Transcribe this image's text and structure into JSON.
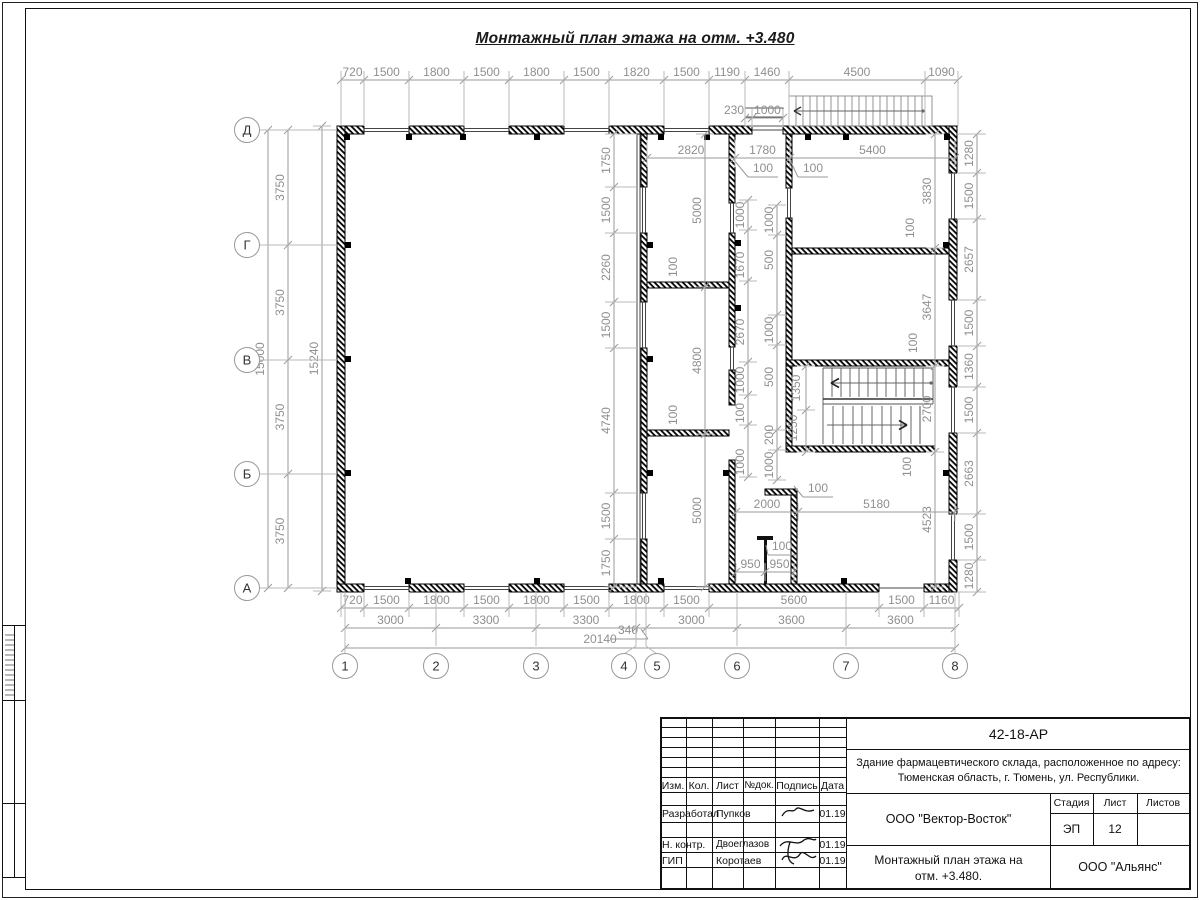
{
  "sheet": {
    "drawing_title": "Монтажный план этажа на отм. +3.480",
    "doc_number": "42-18-АР",
    "project_name_line1": "Здание фармацевтического склада, расположенное по адресу:",
    "project_name_line2": "Тюменская область, г. Тюмень, ул. Республики.",
    "contractor": "ООО \"Вектор-Восток\"",
    "client": "ООО \"Альянс\"",
    "tb_title_line1": "Монтажный план этажа на",
    "tb_title_line2": "отм. +3.480.",
    "stage_label": "Стадия",
    "stage_value": "ЭП",
    "sheet_label": "Лист",
    "sheet_value": "12",
    "sheets_label": "Листов",
    "sheets_value": "",
    "header_cols": [
      "Изм.",
      "Кол.",
      "Лист",
      "№док.",
      "Подпись",
      "Дата"
    ],
    "sign_rows": [
      {
        "role": "Разработал",
        "name": "Пупков",
        "date": "01.19"
      },
      {
        "role": "Н. контр.",
        "name": "Двоеглазов",
        "date": "01.19"
      },
      {
        "role": "ГИП",
        "name": "Коротаев",
        "date": "01.19"
      }
    ]
  },
  "plan": {
    "row_axes": [
      {
        "l": "Д",
        "y": 130
      },
      {
        "l": "Г",
        "y": 245
      },
      {
        "l": "В",
        "y": 360
      },
      {
        "l": "Б",
        "y": 474
      },
      {
        "l": "А",
        "y": 588
      }
    ],
    "col_axes": [
      {
        "l": "1",
        "x": 345,
        "cx": 345
      },
      {
        "l": "2",
        "x": 436,
        "cx": 436
      },
      {
        "l": "3",
        "x": 536,
        "cx": 536
      },
      {
        "l": "4",
        "x": 636,
        "cx": 624
      },
      {
        "l": "5",
        "x": 646,
        "cx": 657
      },
      {
        "l": "6",
        "x": 737,
        "cx": 737
      },
      {
        "l": "7",
        "x": 846,
        "cx": 846
      },
      {
        "l": "8",
        "x": 955,
        "cx": 955
      }
    ],
    "chains": [
      {
        "dir": "h",
        "pos": 80,
        "reach": 126,
        "ticks": [
          341,
          364,
          409,
          464,
          509,
          564,
          609,
          664,
          709,
          745,
          789,
          925,
          958
        ],
        "labels": [
          "720",
          "1500",
          "1800",
          "1500",
          "1800",
          "1500",
          "1820",
          "1500",
          "1190",
          "1460",
          "4500",
          "1090"
        ]
      },
      {
        "dir": "h",
        "pos": 118,
        "reach": 126,
        "ticks": [
          745,
          752,
          783
        ],
        "labels": [
          null,
          "1000"
        ]
      },
      {
        "dir": "h",
        "pos": 158,
        "reach": 140,
        "ticks": [
          647,
          735,
          790,
          955
        ],
        "labels": [
          "2820",
          "1780",
          "5400"
        ]
      },
      {
        "dir": "h",
        "pos": 512,
        "ticks": [
          736,
          798,
          955
        ],
        "labels": [
          "2000",
          "5180"
        ]
      },
      {
        "dir": "h",
        "pos": 572,
        "ticks": [
          736,
          765,
          794
        ],
        "labels": [
          "950",
          "950"
        ]
      },
      {
        "dir": "h",
        "pos": 608,
        "reach": 592,
        "ticks": [
          341,
          364,
          409,
          464,
          509,
          564,
          609,
          664,
          709,
          879,
          924,
          959
        ],
        "labels": [
          "720",
          "1500",
          "1800",
          "1500",
          "1800",
          "1500",
          "1800",
          "1500",
          "5600",
          "1500",
          "1160"
        ]
      },
      {
        "dir": "h",
        "pos": 628,
        "ticks": [
          345,
          436,
          536,
          636,
          646,
          737,
          846,
          955
        ],
        "labels": [
          "3000",
          "3300",
          "3300",
          null,
          "3000",
          "3600",
          "3600"
        ]
      },
      {
        "dir": "h",
        "pos": 648,
        "ticks": [
          345,
          955
        ],
        "labels": [
          null
        ]
      },
      {
        "dir": "v",
        "pos": 268,
        "ticks": [
          130,
          588
        ],
        "labels": [
          "15000"
        ]
      },
      {
        "dir": "v",
        "pos": 288,
        "ticks": [
          130,
          245,
          360,
          474,
          588
        ],
        "labels": [
          "3750",
          "3750",
          "3750",
          "3750"
        ]
      },
      {
        "dir": "v",
        "pos": 322,
        "ticks": [
          126,
          591
        ],
        "labels": [
          "15240"
        ]
      },
      {
        "dir": "v",
        "pos": 614,
        "reach": 637,
        "ticks": [
          134,
          187,
          233,
          302,
          348,
          493,
          539,
          587
        ],
        "labels": [
          "1750",
          "1500",
          "2260",
          "1500",
          "4740",
          "1500",
          "1750"
        ]
      },
      {
        "dir": "v",
        "pos": 705,
        "ticks": [
          134,
          287,
          434,
          587
        ],
        "labels": [
          "5000",
          "4800",
          "5000"
        ]
      },
      {
        "dir": "v",
        "pos": 748,
        "ticks": [
          200,
          230,
          281,
          362,
          395,
          425,
          477
        ],
        "labels": []
      },
      {
        "dir": "v",
        "pos": 777,
        "ticks": [
          205,
          235,
          315,
          345,
          430,
          450,
          480
        ],
        "labels": []
      },
      {
        "dir": "v",
        "pos": 806,
        "ticks": [
          366,
          410,
          452
        ],
        "labels": []
      },
      {
        "dir": "v",
        "pos": 935,
        "ticks": [
          134,
          248,
          366,
          452,
          587
        ],
        "labels": [
          "3830",
          "3647",
          "2700",
          "4523"
        ]
      },
      {
        "dir": "v",
        "pos": 977,
        "reach": 957,
        "ticks": [
          134,
          173,
          219,
          300,
          346,
          387,
          433,
          514,
          560,
          592
        ],
        "labels": [
          "1280",
          "1500",
          "2657",
          "1500",
          "1360",
          "1500",
          "2663",
          "1500",
          "1280"
        ]
      }
    ],
    "labels": [
      {
        "t": "340",
        "x": 628,
        "y": 634,
        "r": 0
      },
      {
        "t": "20140",
        "x": 600,
        "y": 643,
        "r": 0
      },
      {
        "t": "230",
        "x": 734,
        "y": 114,
        "r": 0
      },
      {
        "t": "1000",
        "x": 744,
        "y": 215,
        "r": 1
      },
      {
        "t": "1670",
        "x": 744,
        "y": 265,
        "r": 1
      },
      {
        "t": "2670",
        "x": 744,
        "y": 332,
        "r": 1
      },
      {
        "t": "1000",
        "x": 744,
        "y": 380,
        "r": 1
      },
      {
        "t": "100",
        "x": 744,
        "y": 413,
        "r": 1
      },
      {
        "t": "1000",
        "x": 744,
        "y": 462,
        "r": 1
      },
      {
        "t": "1000",
        "x": 773,
        "y": 220,
        "r": 1
      },
      {
        "t": "500",
        "x": 773,
        "y": 260,
        "r": 1
      },
      {
        "t": "1000",
        "x": 773,
        "y": 330,
        "r": 1
      },
      {
        "t": "500",
        "x": 773,
        "y": 377,
        "r": 1
      },
      {
        "t": "200",
        "x": 773,
        "y": 435,
        "r": 1
      },
      {
        "t": "1000",
        "x": 773,
        "y": 465,
        "r": 1
      },
      {
        "t": "100",
        "x": 763,
        "y": 172,
        "r": 0
      },
      {
        "t": "100",
        "x": 813,
        "y": 172,
        "r": 0
      },
      {
        "t": "100",
        "x": 914,
        "y": 228,
        "r": 1
      },
      {
        "t": "100",
        "x": 917,
        "y": 343,
        "r": 1
      },
      {
        "t": "100",
        "x": 677,
        "y": 267,
        "r": 1
      },
      {
        "t": "100",
        "x": 677,
        "y": 415,
        "r": 1
      },
      {
        "t": "100",
        "x": 911,
        "y": 467,
        "r": 1
      },
      {
        "t": "100",
        "x": 818,
        "y": 492,
        "r": 0
      },
      {
        "t": "100",
        "x": 782,
        "y": 550,
        "r": 0
      },
      {
        "t": "1350",
        "x": 800,
        "y": 388,
        "r": 1
      },
      {
        "t": "1250",
        "x": 797,
        "y": 428,
        "r": 1
      }
    ]
  }
}
